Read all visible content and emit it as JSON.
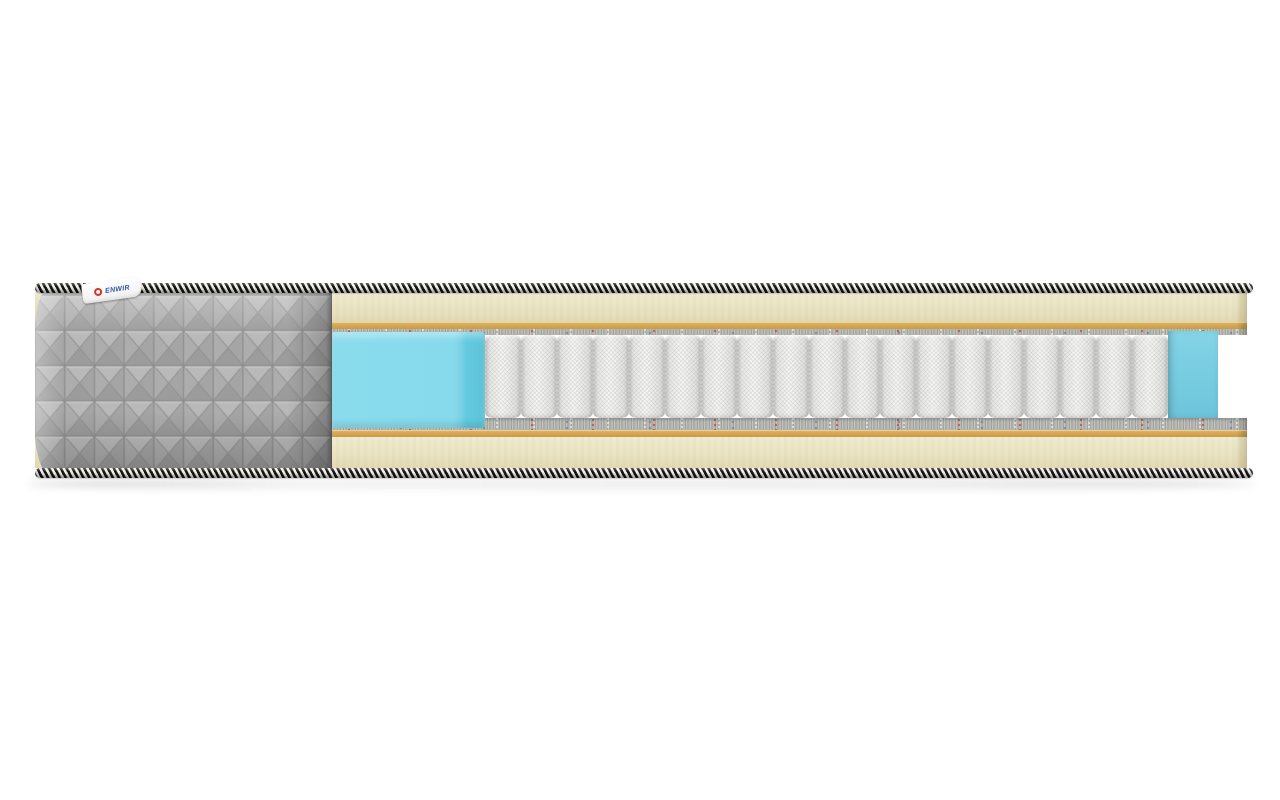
{
  "scene": {
    "type": "product-photo",
    "subject": "mattress cross-section cutaway",
    "background": "#ffffff"
  },
  "brand_label": {
    "text": "ENWIR",
    "logo_icon": "red-ring-emblem"
  },
  "construction": {
    "trim": "black-and-white braided edge cord, top and bottom",
    "cover": "grey quilted fabric cover with square stitch pattern",
    "layers_top_to_bottom": [
      {
        "name": "quilted cover",
        "color": "#ababab"
      },
      {
        "name": "foam comfort layer",
        "color": "#eae3c2"
      },
      {
        "name": "coir pad",
        "color": "#d4a855"
      },
      {
        "name": "felt insulator pad",
        "color": "#b0b0ad"
      },
      {
        "name": "pocket spring block",
        "color": "#f6f6f4"
      },
      {
        "name": "felt insulator pad",
        "color": "#b0b0ad"
      },
      {
        "name": "coir pad",
        "color": "#d4a855"
      },
      {
        "name": "foam comfort layer",
        "color": "#eae3c2"
      }
    ],
    "edge_support_foam": {
      "color": "#8adced",
      "position": "around spring block, cut face left and inner wall right"
    }
  },
  "springs": {
    "count": 19,
    "style": "fabric-wrapped pocket coils"
  },
  "colors": {
    "cream": "#eae3c2",
    "cream-light": "#f0ebcf",
    "cream-dark": "#e2d9b4",
    "tan": "#d4a855",
    "tan-light": "#e2ba67",
    "tan-dark": "#c89b49",
    "felt": "#b0b0ad",
    "blue": "#8adced",
    "blue-face": "#63cadf",
    "blue-wall": "#6cc4da",
    "cover": "#ababab",
    "spring": "#f6f6f4",
    "label-blue": "#2b55a3",
    "label-red": "#d93025"
  }
}
